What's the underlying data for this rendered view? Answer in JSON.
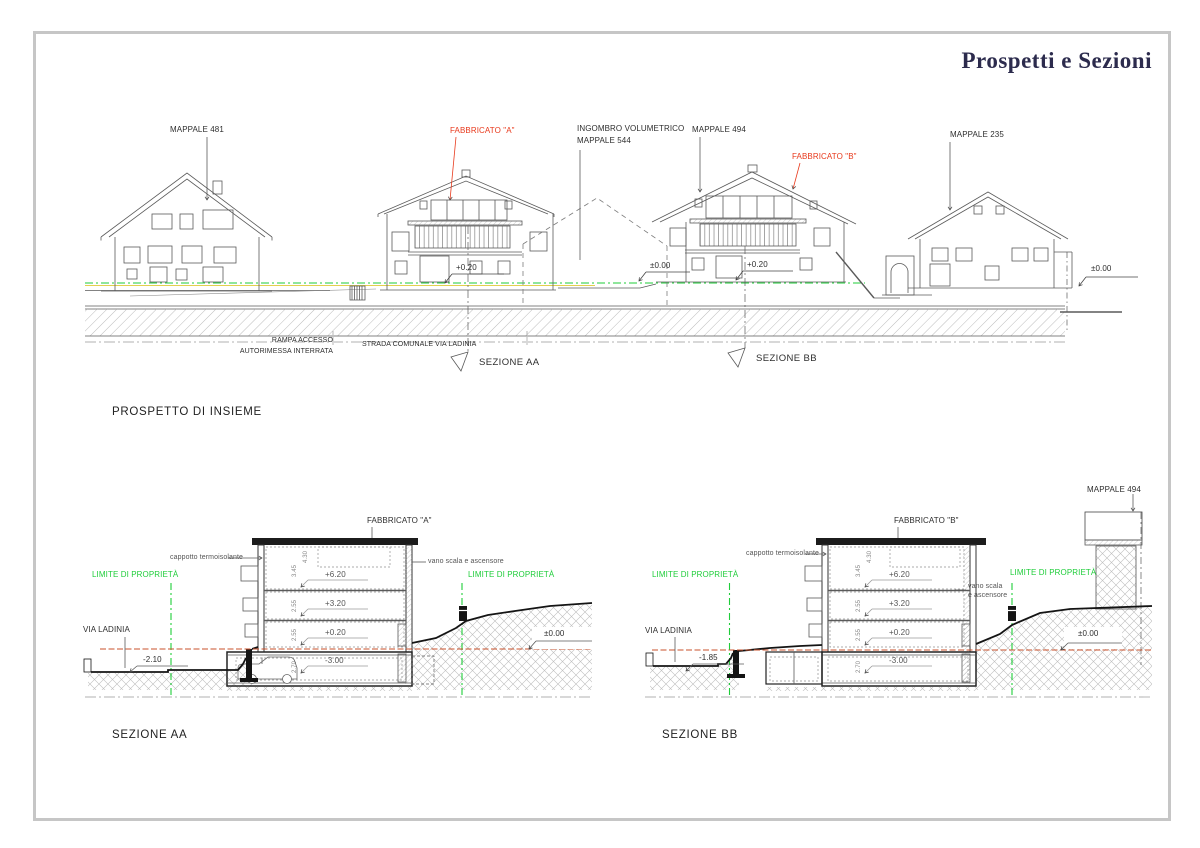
{
  "sheet": {
    "title": "Prospetti e Sezioni"
  },
  "colors": {
    "accent_red": "#e8391c",
    "boundary_green": "#1fcd3a",
    "ref_line_red": "#c8502b",
    "title_navy": "#2c2b4d"
  },
  "prospetto": {
    "title": "PROSPETTO DI INSIEME",
    "mappale481": "MAPPALE 481",
    "fabbricato_a": "FABBRICATO \"A\"",
    "ingombro_line1": "INGOMBRO VOLUMETRICO",
    "ingombro_line2": "MAPPALE 544",
    "mappale494": "MAPPALE 494",
    "fabbricato_b": "FABBRICATO \"B\"",
    "mappale235": "MAPPALE 235",
    "rampa_line1": "RAMPA ACCESSO",
    "rampa_line2": "AUTORIMESSA INTERRATA",
    "strada": "STRADA COMUNALE VIA LADINIA",
    "sezione_aa": "SEZIONE AA",
    "sezione_bb": "SEZIONE BB",
    "lvl_a": "+0.20",
    "lvl_mid": "±0.00",
    "lvl_b": "+0.20",
    "lvl_right": "±0.00"
  },
  "sezione_aa": {
    "title": "SEZIONE AA",
    "fabbricato": "FABBRICATO \"A\"",
    "cappotto": "cappotto termoisolante",
    "vano": "vano scala e ascensore",
    "limite_sx": "LIMITE DI PROPRIETÀ",
    "limite_dx": "LIMITE DI PROPRIETÀ",
    "via": "VIA LADINIA",
    "lvl_strada": "-2.10",
    "lvl_p2": "+6.20",
    "lvl_p1": "+3.20",
    "lvl_pt": "+0.20",
    "lvl_int": "-3.00",
    "lvl_zero": "±0.00",
    "dims": [
      "4.30",
      "3.45",
      "2.55",
      "2.55",
      "2.70"
    ]
  },
  "sezione_bb": {
    "title": "SEZIONE BB",
    "fabbricato": "FABBRICATO \"B\"",
    "mappale": "MAPPALE 494",
    "cappotto": "cappotto termoisolante",
    "vano_line1": "vano scala",
    "vano_line2": "e ascensore",
    "limite_sx": "LIMITE DI PROPRIETÀ",
    "limite_dx": "LIMITE DI PROPRIETÀ",
    "via": "VIA LADINIA",
    "lvl_strada": "-1.85",
    "lvl_p2": "+6.20",
    "lvl_p1": "+3.20",
    "lvl_pt": "+0.20",
    "lvl_int": "-3.00",
    "lvl_zero": "±0.00",
    "dims": [
      "4.30",
      "3.45",
      "2.55",
      "2.55",
      "2.70"
    ]
  }
}
